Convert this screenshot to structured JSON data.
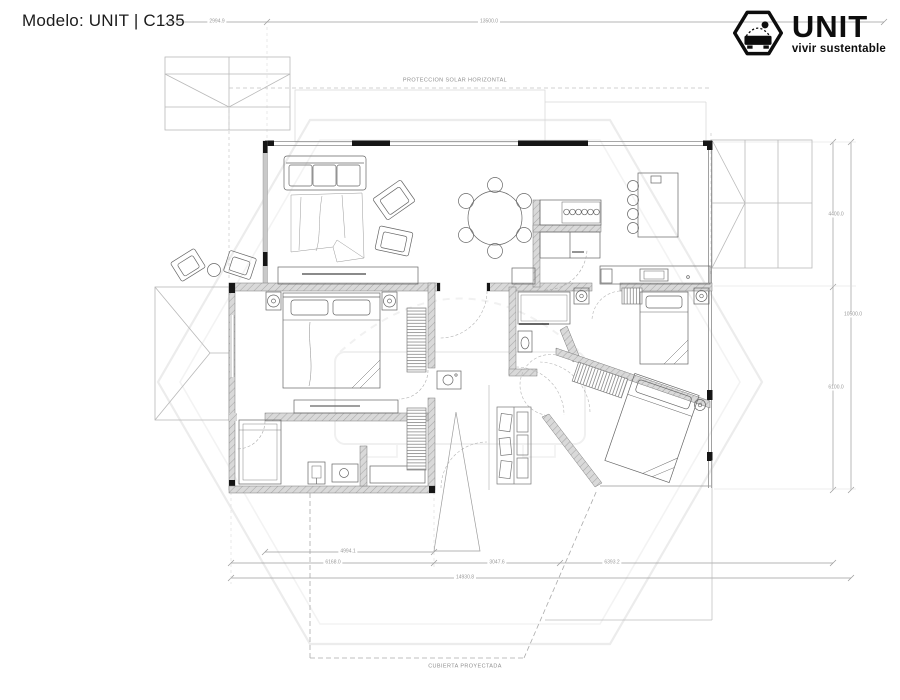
{
  "header": {
    "title": "Modelo: UNIT | C135"
  },
  "logo": {
    "brand": "UNIT",
    "tagline": "vivir sustentable"
  },
  "annotations": {
    "solar_protection": "PROTECCION SOLAR HORIZONTAL",
    "projected_roof": "CUBIERTA PROYECTADA"
  },
  "dimensions": {
    "top_left": "2994.9",
    "top_span": "13500.0",
    "right_upper": "4400.0",
    "right_lower": "6100.0",
    "right_total": "10500.0",
    "bottom_row1": "4994.1",
    "bottom_row2_left": "6168.0",
    "bottom_row2_mid": "3047.6",
    "bottom_row2_right": "6393.2",
    "bottom_total": "14930.8"
  }
}
